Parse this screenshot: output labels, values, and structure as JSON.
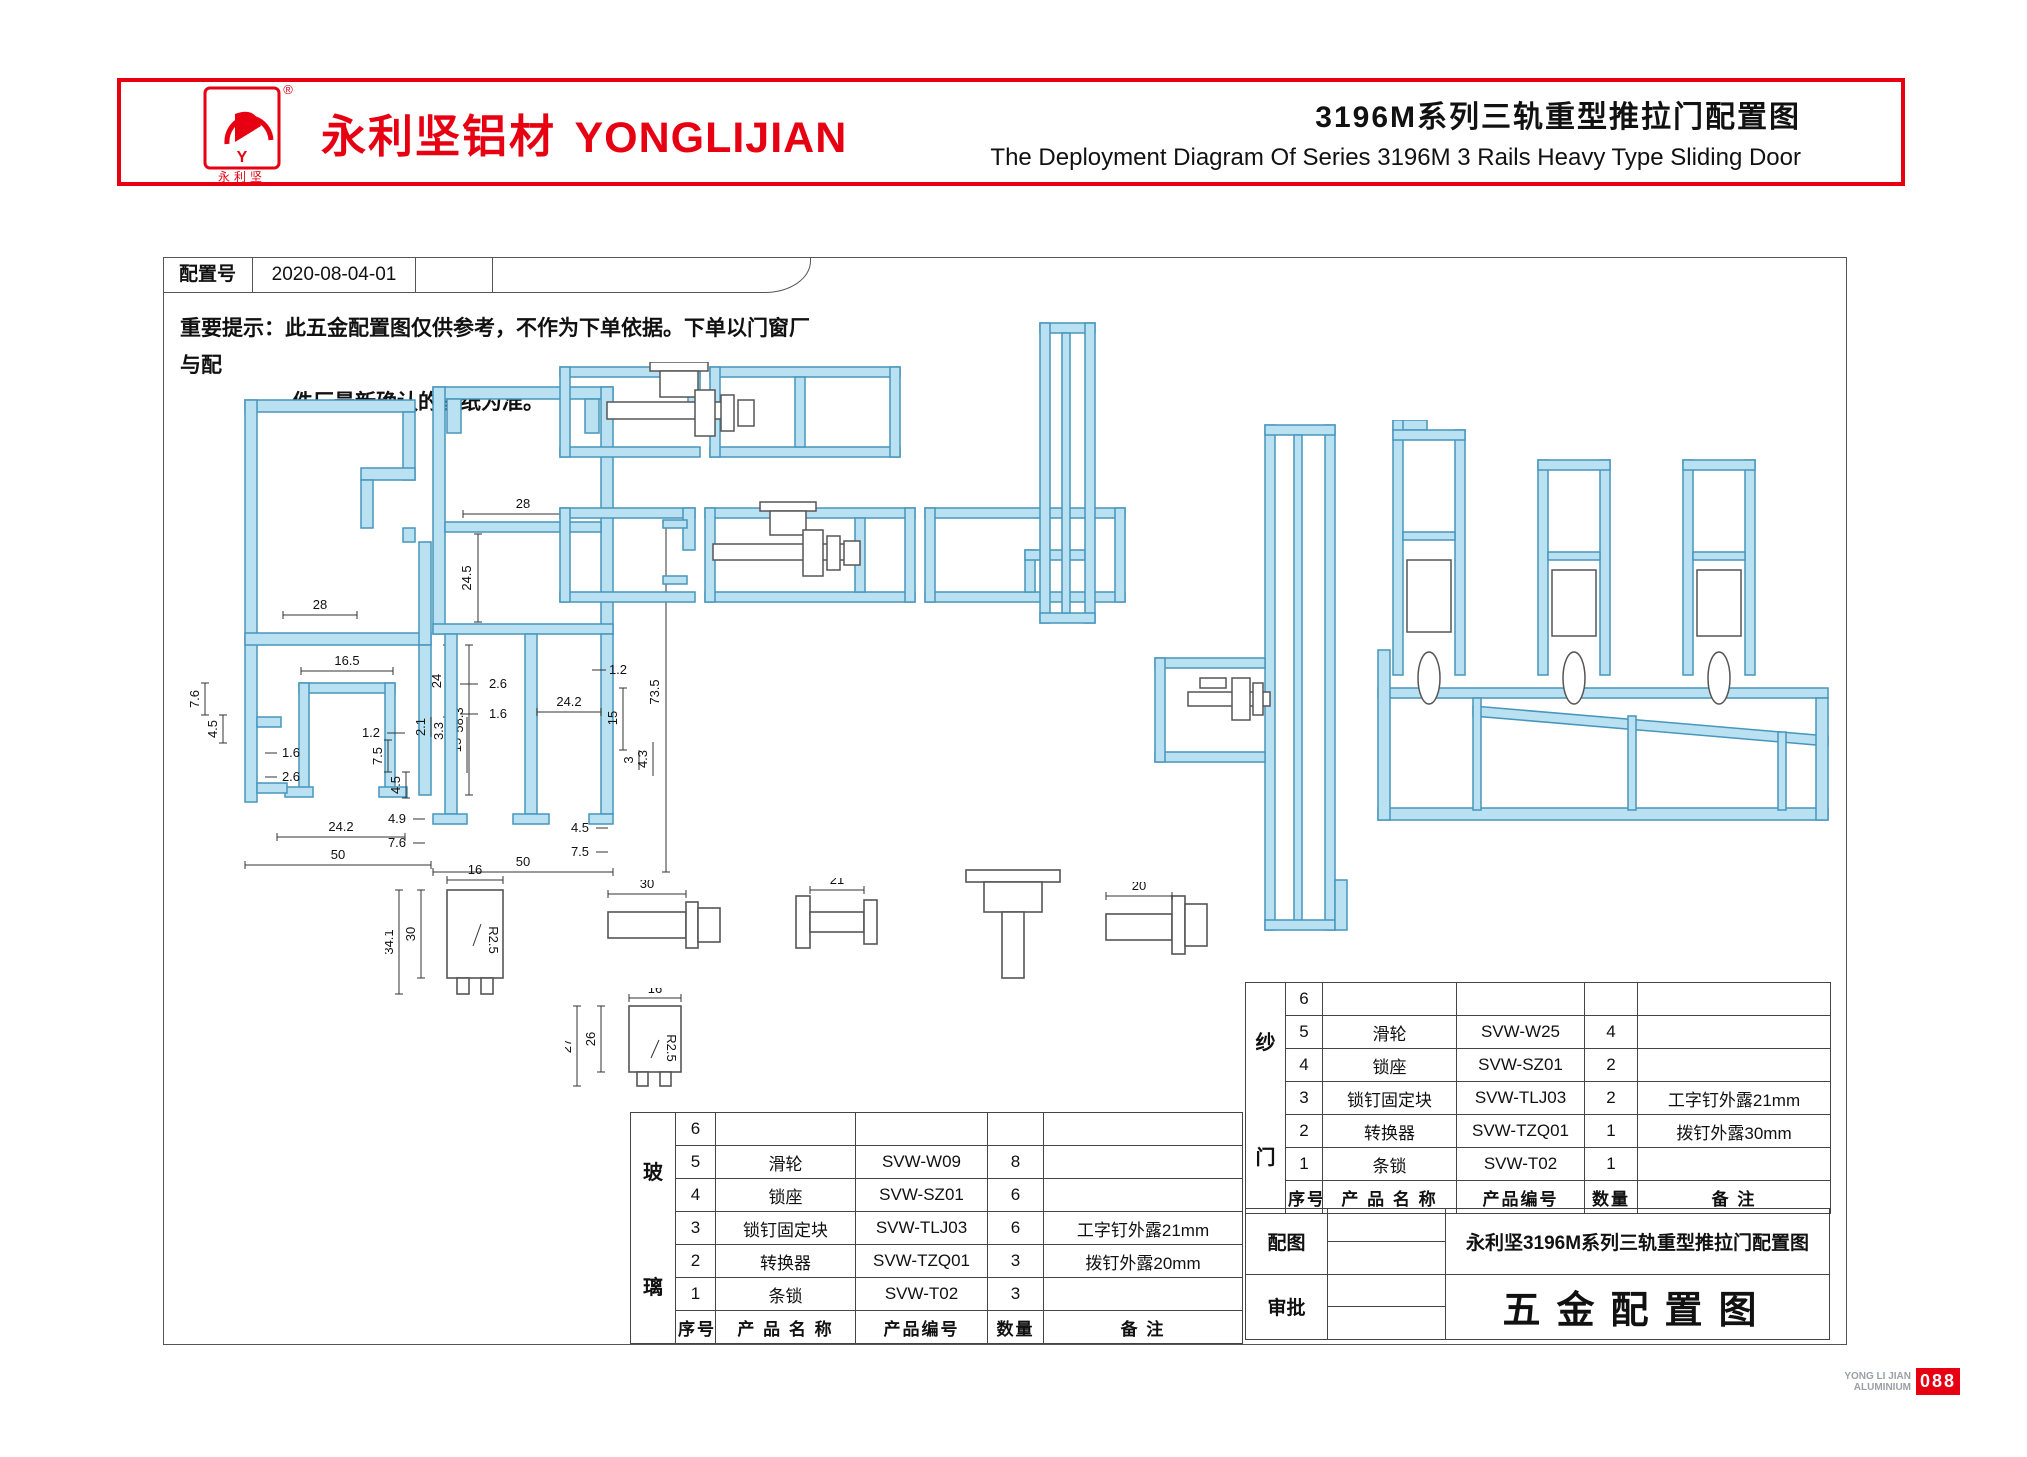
{
  "header": {
    "brand_cn": "永利坚铝材",
    "brand_en": "YONGLIJIAN",
    "registered_mark": "®",
    "logo_text": "永利坚",
    "title_cn": "3196M系列三轨重型推拉门配置图",
    "title_en": "The Deployment Diagram Of Series 3196M 3 Rails Heavy Type Sliding Door",
    "accent_color": "#e60012"
  },
  "config": {
    "label": "配置号",
    "value": "2020-08-04-01"
  },
  "notice": {
    "line1": "重要提示：此五金配置图仅供参考，不作为下单依据。下单以门窗厂与配",
    "line2": "件厂最新确认的图纸为准。"
  },
  "drawings": {
    "profile_fill": "#b9e1f1",
    "profile_stroke": "#4796bc",
    "profile_a": {
      "dims": [
        "28",
        "16.5",
        "1.2",
        "24",
        "58.3",
        "7.6",
        "4.5",
        "1.6",
        "2.6",
        "2.1",
        "3.3",
        "15",
        "4.9",
        "7.6",
        "24.2",
        "50"
      ]
    },
    "profile_b": {
      "dims": [
        "28",
        "24.5",
        "2.6",
        "1.6",
        "1.2",
        "7.5",
        "4.5",
        "24.2",
        "15",
        "3",
        "4.3",
        "4.5",
        "7.5",
        "50",
        "73.5"
      ]
    },
    "parts": {
      "block_large": {
        "dims": [
          "16",
          "34.1",
          "30",
          "R2.5"
        ]
      },
      "pin_a": {
        "dims": [
          "30"
        ]
      },
      "pin_b": {
        "dims": [
          "21"
        ]
      },
      "pin_c": {
        "dims": [
          "20"
        ]
      },
      "block_small": {
        "dims": [
          "16",
          "27",
          "26",
          "R2.5"
        ]
      }
    }
  },
  "tables": {
    "glass": {
      "group_label": [
        "玻",
        "璃"
      ],
      "headers": [
        "序号",
        "产 品 名 称",
        "产品编号",
        "数量",
        "备 注"
      ],
      "rows": [
        {
          "no": "6",
          "name": "",
          "code": "",
          "qty": "",
          "note": ""
        },
        {
          "no": "5",
          "name": "滑轮",
          "code": "SVW-W09",
          "qty": "8",
          "note": ""
        },
        {
          "no": "4",
          "name": "锁座",
          "code": "SVW-SZ01",
          "qty": "6",
          "note": ""
        },
        {
          "no": "3",
          "name": "锁钉固定块",
          "code": "SVW-TLJ03",
          "qty": "6",
          "note": "工字钉外露21mm"
        },
        {
          "no": "2",
          "name": "转换器",
          "code": "SVW-TZQ01",
          "qty": "3",
          "note": "拨钉外露20mm"
        },
        {
          "no": "1",
          "name": "条锁",
          "code": "SVW-T02",
          "qty": "3",
          "note": ""
        }
      ]
    },
    "screen": {
      "group_label": [
        "纱",
        "门"
      ],
      "headers": [
        "序号",
        "产 品 名 称",
        "产品编号",
        "数量",
        "备 注"
      ],
      "rows": [
        {
          "no": "6",
          "name": "",
          "code": "",
          "qty": "",
          "note": ""
        },
        {
          "no": "5",
          "name": "滑轮",
          "code": "SVW-W25",
          "qty": "4",
          "note": ""
        },
        {
          "no": "4",
          "name": "锁座",
          "code": "SVW-SZ01",
          "qty": "2",
          "note": ""
        },
        {
          "no": "3",
          "name": "锁钉固定块",
          "code": "SVW-TLJ03",
          "qty": "2",
          "note": "工字钉外露21mm"
        },
        {
          "no": "2",
          "name": "转换器",
          "code": "SVW-TZQ01",
          "qty": "1",
          "note": "拨钉外露30mm"
        },
        {
          "no": "1",
          "name": "条锁",
          "code": "SVW-T02",
          "qty": "1",
          "note": ""
        }
      ]
    },
    "title_block": {
      "config_label": "配图",
      "config_text": "永利坚3196M系列三轨重型推拉门配置图",
      "approve_label": "审批",
      "approve_text": "五金配置图"
    }
  },
  "footer": {
    "brand_line1": "YONG LI JIAN",
    "brand_line2": "ALUMINIUM",
    "page_number": "088"
  }
}
